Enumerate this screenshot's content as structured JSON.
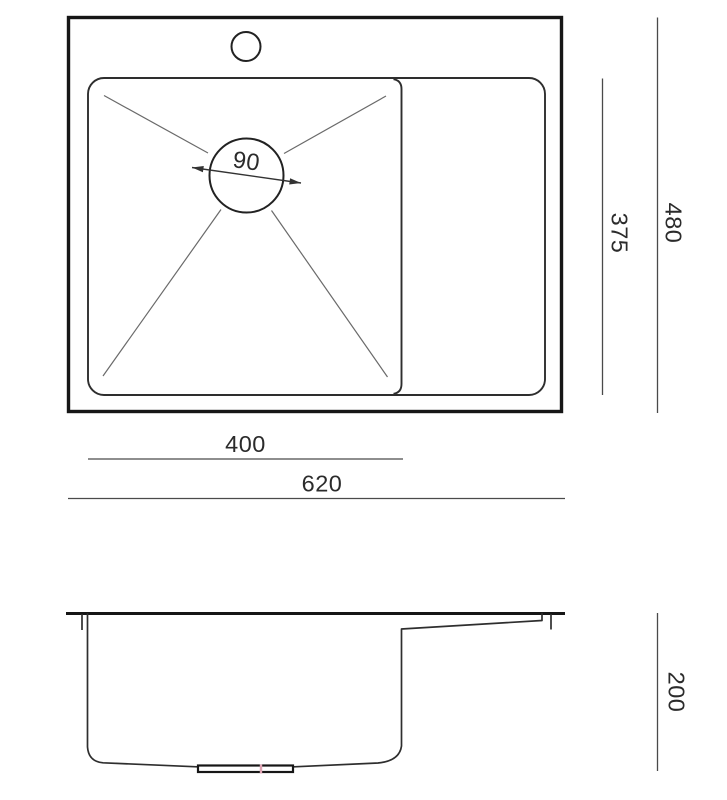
{
  "colors": {
    "background": "#ffffff",
    "outline_heavy": "#161616",
    "outline_medium": "#2e2e2e",
    "thin_line": "#6a6a6a",
    "dimension_line": "#4a4a4a",
    "drain_accent_pink": "#e0a4b4"
  },
  "views": {
    "top": {
      "dim_drain_diameter": "90",
      "dim_bowl_width": "400",
      "dim_overall_width": "620",
      "dim_bowl_depth": "375",
      "dim_overall_depth": "480"
    },
    "side": {
      "dim_overall_height": "200"
    }
  }
}
